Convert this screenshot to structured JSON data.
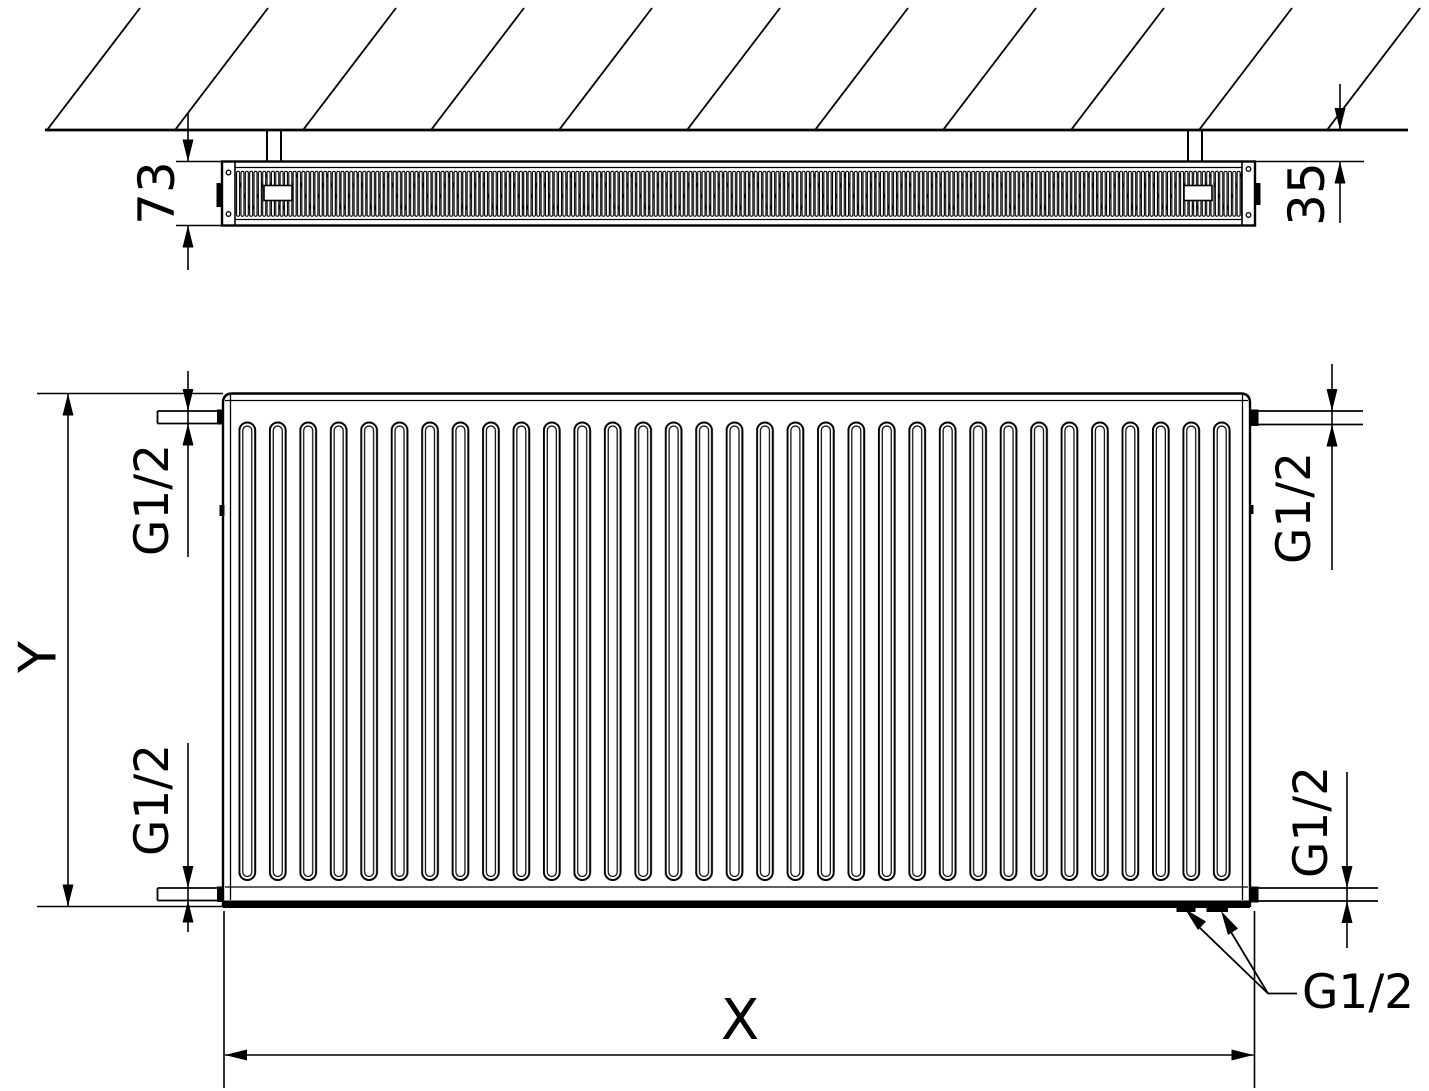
{
  "meta": {
    "background_color": "#ffffff",
    "line_color": "#000000",
    "drawing_type": "panel radiator technical dimension drawing"
  },
  "top_view": {
    "depth_dim_label": "73",
    "wall_gap_dim_label": "35"
  },
  "front_view": {
    "height_dim_label": "Y",
    "width_dim_label": "X",
    "connection_labels": {
      "top_left": "G1/2",
      "bottom_left": "G1/2",
      "top_right": "G1/2",
      "bottom_right": "G1/2",
      "bottom_callout": "G1/2"
    }
  }
}
